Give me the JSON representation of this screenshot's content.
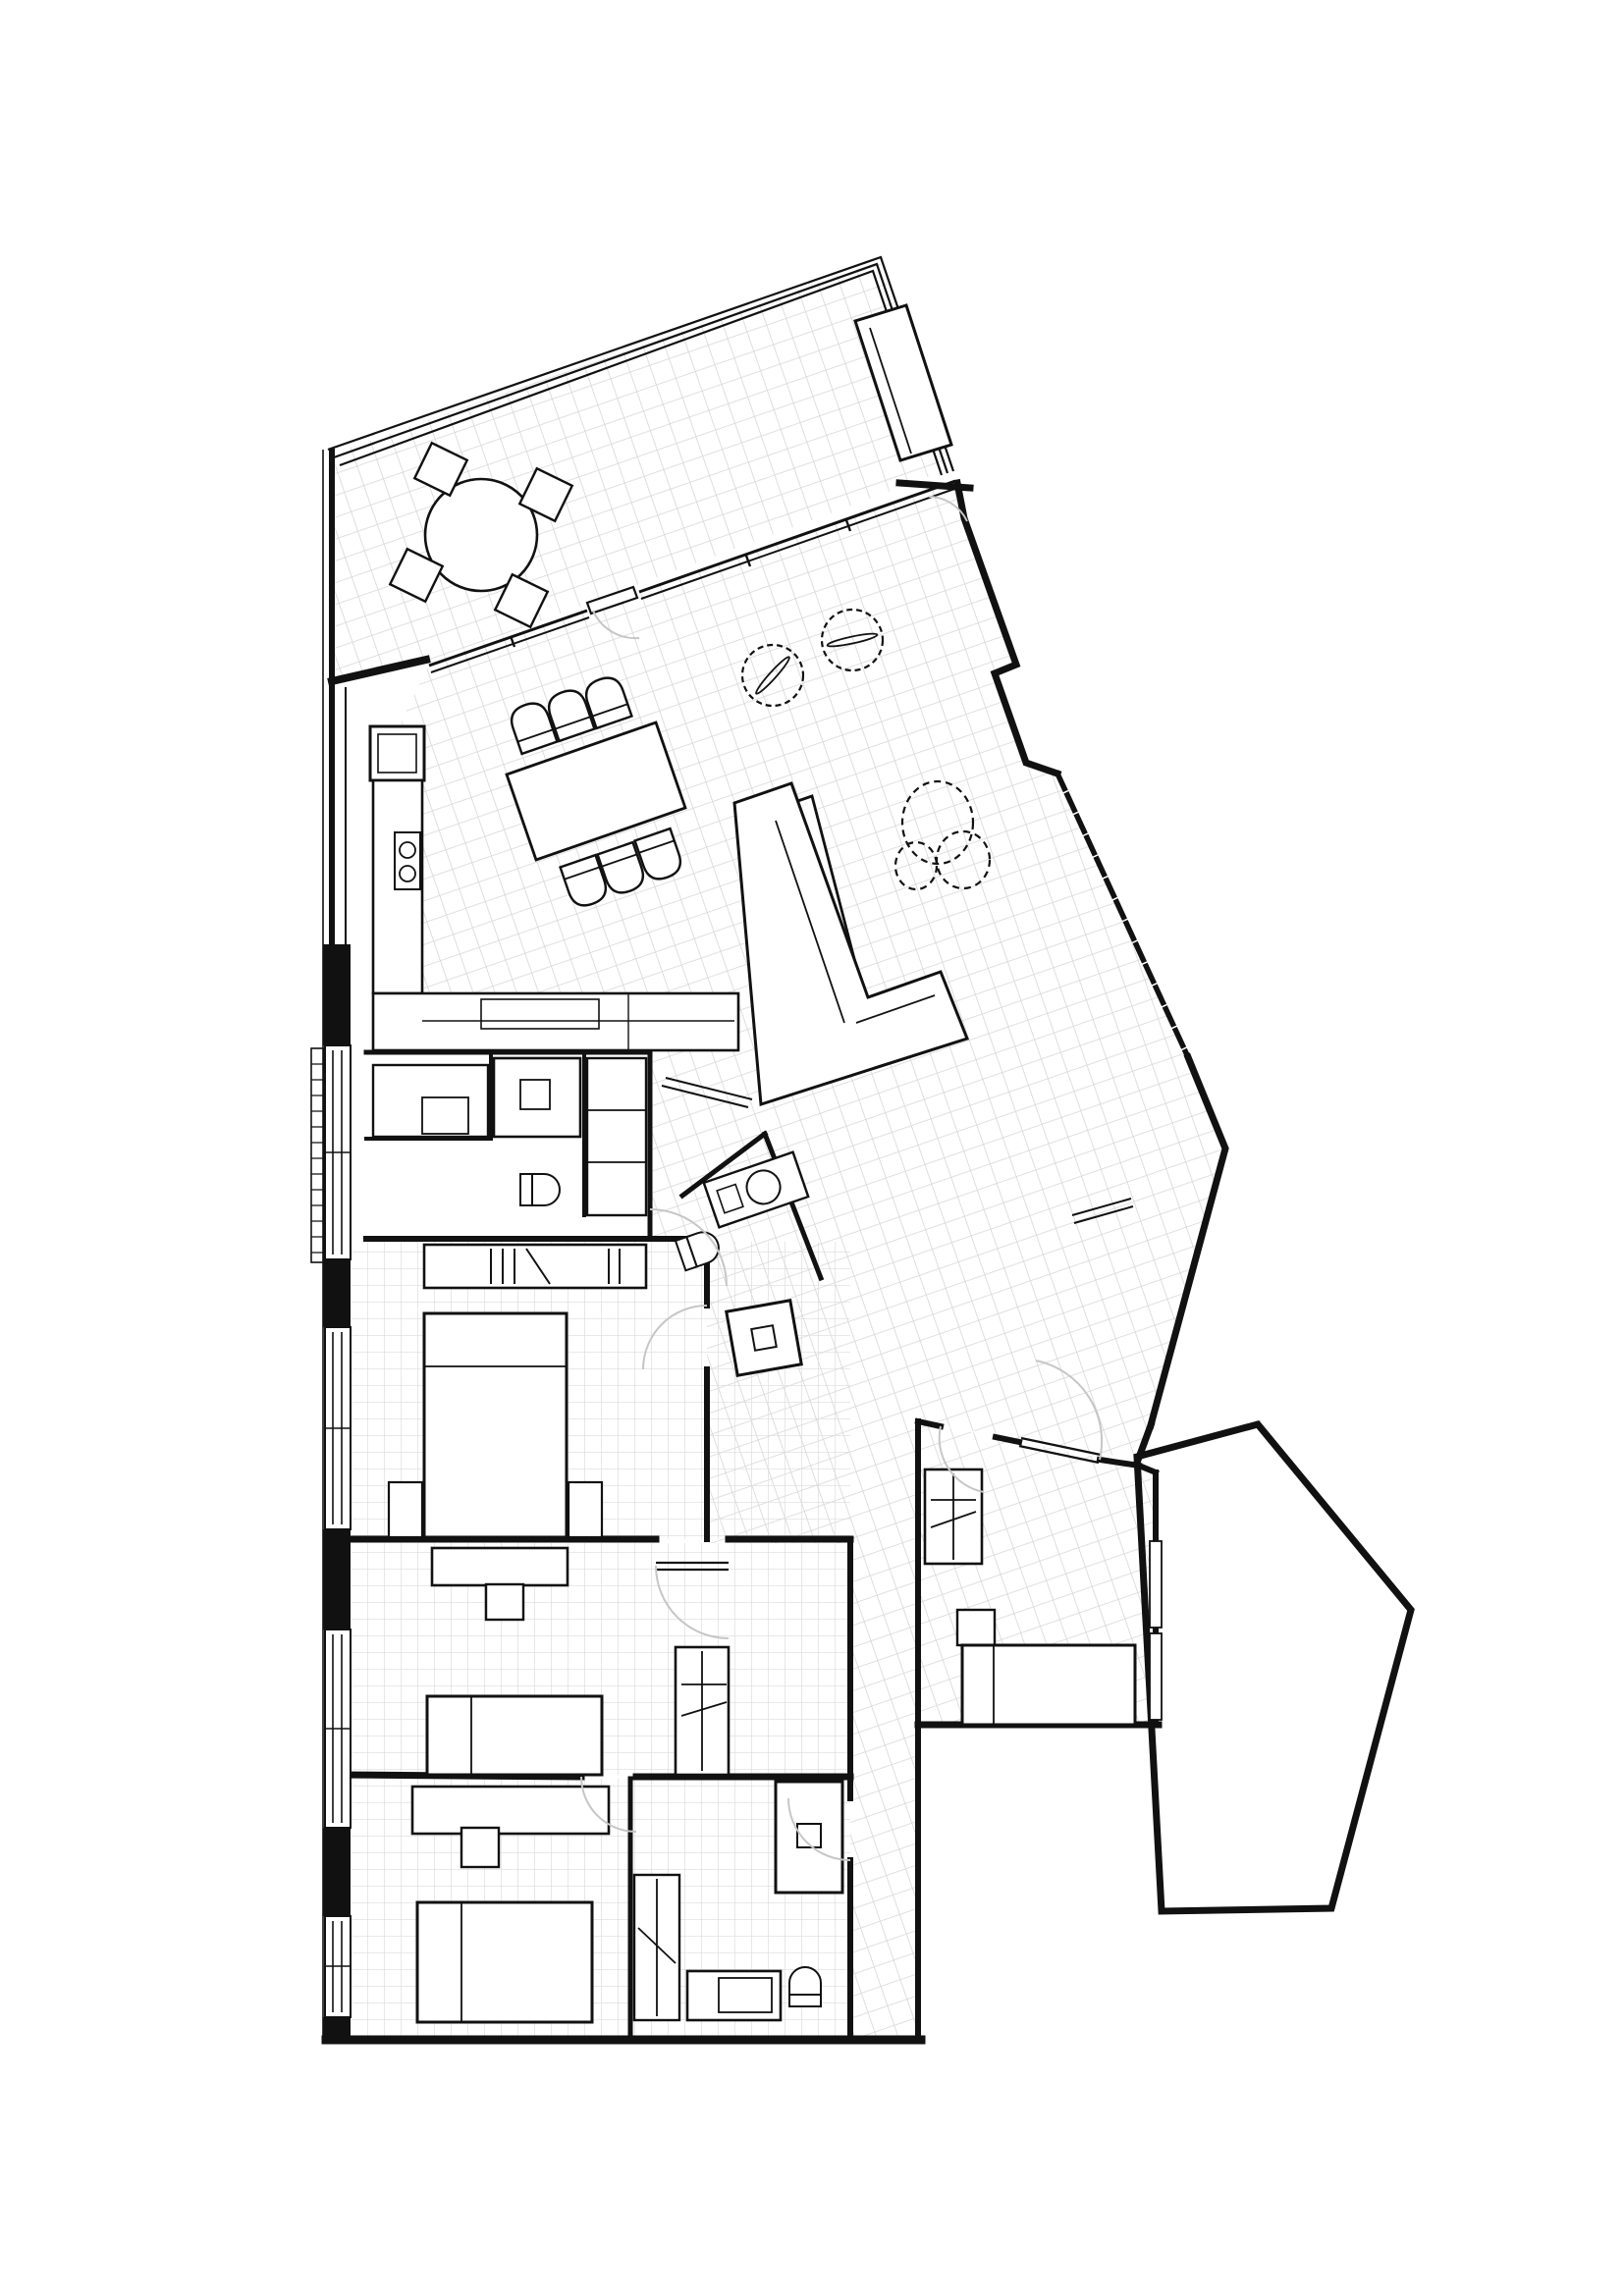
{
  "document": {
    "title": "Apartment floor plan drawing",
    "type": "architectural-floor-plan",
    "view": "top-down plan",
    "visible_text": [],
    "colors": {
      "background": "#ffffff",
      "walls": "#111111",
      "tile_grid": "#d6d6d6",
      "fine_grid": "#dcdcdc",
      "door_swing": "#c6c6c6",
      "furniture_fill": "#ffffff"
    },
    "tile_grid_angle_deg": -19
  },
  "plan": {
    "rooms": [
      {
        "id": "terrace",
        "label": "terrace",
        "floor": "rotated square tile hatch",
        "position": "top-left, rotated wing"
      },
      {
        "id": "living-dining-kitchen",
        "label": "open living / dining / kitchen",
        "floor": "rotated square tile hatch",
        "position": "upper middle, rotated wing"
      },
      {
        "id": "hallway",
        "label": "hallway / circulation",
        "floor": "rotated square tile hatch",
        "position": "center, sloping band to entry"
      },
      {
        "id": "laundry-room",
        "label": "laundry / utility room",
        "floor": "plain",
        "position": "middle left"
      },
      {
        "id": "guest-wc",
        "label": "guest WC",
        "floor": "rotated tile",
        "position": "center of hall"
      },
      {
        "id": "bedroom-1",
        "label": "bedroom 1 (double)",
        "floor": "fine axis grid",
        "position": "left, below utility block"
      },
      {
        "id": "bedroom-2",
        "label": "bedroom 2",
        "floor": "fine axis grid",
        "position": "left, middle band"
      },
      {
        "id": "bedroom-3",
        "label": "bedroom 3",
        "floor": "fine axis grid",
        "position": "bottom left"
      },
      {
        "id": "bedroom-4",
        "label": "bedroom 4 (right wing)",
        "floor": "rotated square tile hatch",
        "position": "center right, below entry"
      },
      {
        "id": "bathroom",
        "label": "bathroom",
        "floor": "fine axis grid",
        "position": "bottom center"
      },
      {
        "id": "corridor",
        "label": "bedroom corridor",
        "floor": "tile",
        "position": "vertical strip between bedrooms and right wing"
      },
      {
        "id": "adjacent-terrace",
        "label": "adjacent open area / terrace outline",
        "floor": "plain white",
        "position": "right, large pentagon outline"
      }
    ],
    "furniture": [
      {
        "room": "terrace",
        "item": "round bistro table"
      },
      {
        "room": "terrace",
        "item": "four diamond-set chairs"
      },
      {
        "room": "terrace",
        "item": "long planter at parapet"
      },
      {
        "room": "living-dining-kitchen",
        "item": "dining table with six chairs"
      },
      {
        "room": "living-dining-kitchen",
        "item": "kitchen L-counter with cooktop"
      },
      {
        "room": "living-dining-kitchen",
        "item": "kitchen island"
      },
      {
        "room": "living-dining-kitchen",
        "item": "tall fridge cabinet"
      },
      {
        "room": "living-dining-kitchen",
        "item": "L-shaped sofa"
      },
      {
        "room": "living-dining-kitchen",
        "item": "TV sideboard"
      },
      {
        "room": "living-dining-kitchen",
        "item": "two round potted plants"
      },
      {
        "room": "living-dining-kitchen",
        "item": "large leafy plant"
      },
      {
        "room": "laundry-room",
        "item": "washing machine"
      },
      {
        "room": "laundry-room",
        "item": "counter cabinet"
      },
      {
        "room": "laundry-room",
        "item": "tall storage column"
      },
      {
        "room": "laundry-room",
        "item": "toilet"
      },
      {
        "room": "guest-wc",
        "item": "vanity basin"
      },
      {
        "room": "guest-wc",
        "item": "toilet"
      },
      {
        "room": "hallway",
        "item": "shower cabin"
      },
      {
        "room": "bedroom-1",
        "item": "double bed with two nightstands"
      },
      {
        "room": "bedroom-1",
        "item": "open wardrobe with hanging rails"
      },
      {
        "room": "bedroom-2",
        "item": "bed"
      },
      {
        "room": "bedroom-2",
        "item": "headboard shelf and side table"
      },
      {
        "room": "bedroom-2",
        "item": "wardrobe"
      },
      {
        "room": "bedroom-3",
        "item": "desk and chair"
      },
      {
        "room": "bedroom-3",
        "item": "bed"
      },
      {
        "room": "bathroom",
        "item": "shower tray"
      },
      {
        "room": "bathroom",
        "item": "vanity counter"
      },
      {
        "room": "bathroom",
        "item": "toilet"
      },
      {
        "room": "bathroom",
        "item": "tall cabinet"
      },
      {
        "room": "bedroom-4",
        "item": "bed with headboard shelf"
      },
      {
        "room": "bedroom-4",
        "item": "wardrobe"
      }
    ],
    "architectural_symbols": [
      {
        "symbol": "door-swing-arc",
        "count": 9
      },
      {
        "symbol": "sliding-door-lines",
        "count": 2
      },
      {
        "symbol": "window-double-line",
        "locations": "left facade (4 units), glazed wall between terrace and living room, bedroom-4 right wall"
      },
      {
        "symbol": "radiator-hatch",
        "location": "left facade top window"
      },
      {
        "symbol": "terrace-parapet-triple-line",
        "location": "terrace top edge"
      }
    ]
  }
}
